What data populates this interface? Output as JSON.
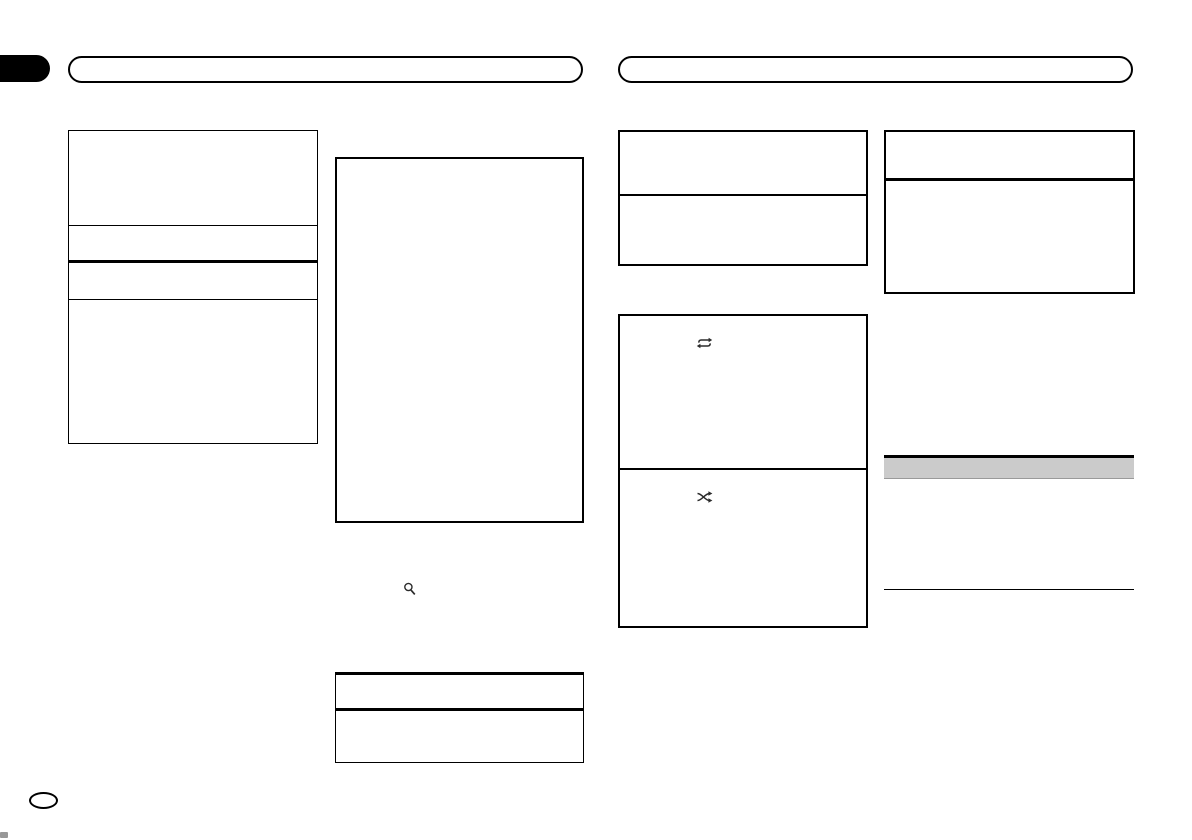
{
  "document": {
    "kind": "scanned-manual-page",
    "colors": {
      "background": "#ffffff",
      "line": "#000000",
      "highlight_bar": "#cbcbcb",
      "icon": "#2b2b2b",
      "edge_tab_fill": "#000000"
    }
  },
  "icons": {
    "search": {
      "name": "search-icon",
      "depicts": "magnifying glass"
    },
    "repeat": {
      "name": "repeat-icon",
      "depicts": "two arrows forming a loop"
    },
    "shuffle": {
      "name": "shuffle-icon",
      "depicts": "crossed shuffle arrows"
    }
  }
}
